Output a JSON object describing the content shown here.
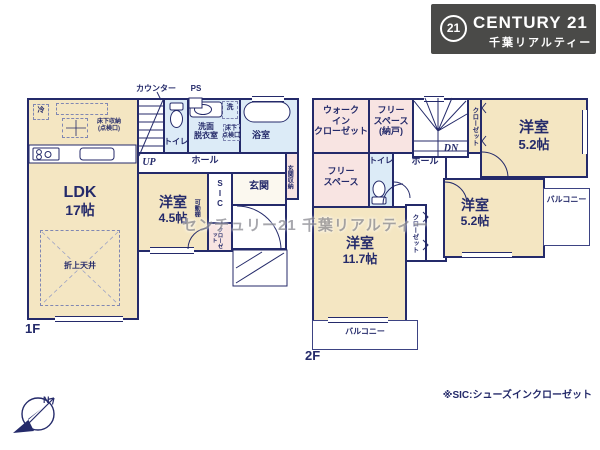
{
  "logo": {
    "circle_text": "21",
    "brand": "CENTURY 21",
    "subtitle": "千葉リアルティー"
  },
  "watermark": "センチュリー21 千葉リアルティー",
  "footnote": "※SIC:シューズインクローゼット",
  "compass": {
    "north": "N"
  },
  "floor1": {
    "floor_label": "1F",
    "counter": "カウンター",
    "ps": "PS",
    "fridge": "冷",
    "underfloor_storage": "床下収納\n(点検口)",
    "ldk_name": "LDK",
    "ldk_size": "17帖",
    "coffered_ceiling": "折上天井",
    "up": "UP",
    "toilet": "トイレ",
    "washroom": "洗面\n脱衣室",
    "washer": "洗",
    "underfloor_hatch": "床下\n点検口",
    "bath": "浴室",
    "hall": "ホール",
    "entrance_storage": "玄関収納",
    "sic": "S\nI\nC",
    "entrance": "玄関",
    "bedroom_name": "洋室",
    "bedroom_size": "4.5帖",
    "movable_shelf": "可動棚",
    "closet": "クローゼット"
  },
  "floor2": {
    "floor_label": "2F",
    "wic": "ウォーク\nイン\nクローゼット",
    "free_space_storage": "フリー\nスペース\n(納戸)",
    "dn": "DN",
    "closet_top": "クローゼット",
    "bedroom1_name": "洋室",
    "bedroom1_size": "5.2帖",
    "free_space": "フリー\nスペース",
    "toilet": "トイレ",
    "hall": "ホール",
    "closet_mid": "クローゼット",
    "bedroom2_name": "洋室",
    "bedroom2_size": "5.2帖",
    "balcony_right": "バルコニー",
    "bedroom3_name": "洋室",
    "bedroom3_size": "11.7帖",
    "balcony_bottom": "バルコニー"
  },
  "colors": {
    "wall": "#242a6a",
    "beige": "#f4e6c2",
    "blue": "#dcebf7",
    "pink": "#f8e4e2",
    "logo_bg": "#4a4a48"
  }
}
